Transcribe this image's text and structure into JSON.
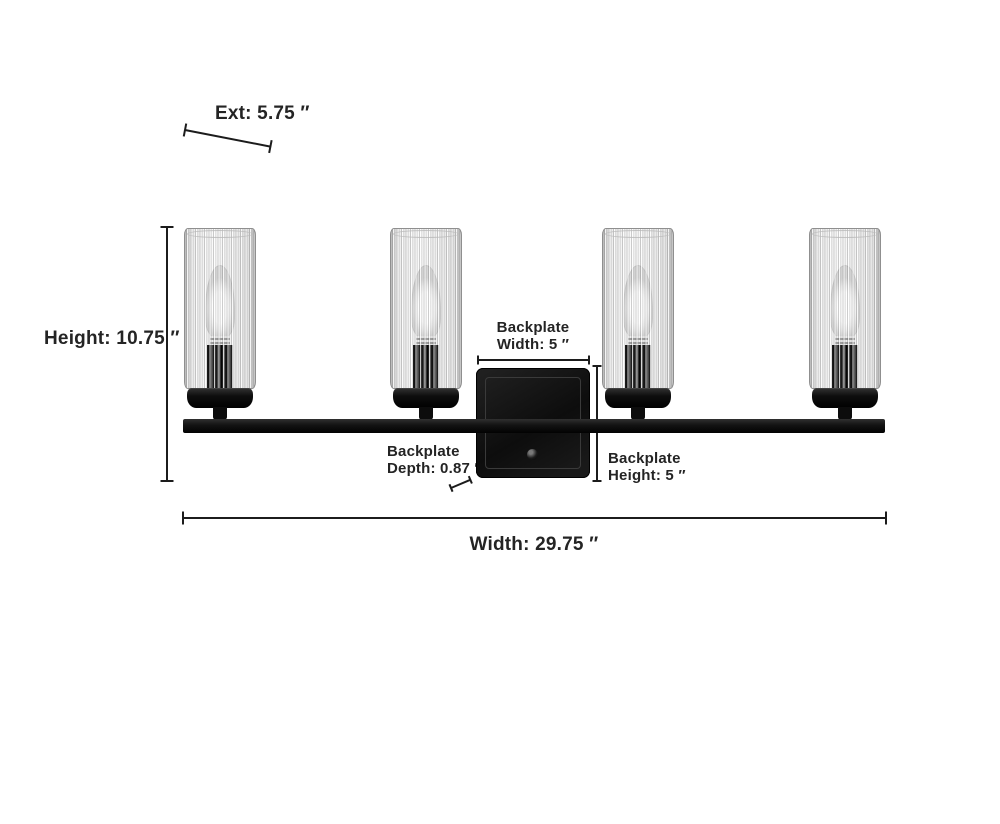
{
  "background": "#ffffff",
  "fixture": {
    "description": "4-light black bath vanity fixture with fluted clear glass cylinder shades and square backplate",
    "num_lights": 4,
    "finish_color": "#121212",
    "glass_color": "#f4f4f4"
  },
  "annotations": {
    "ext": "Ext: 5.75 ″",
    "height": "Height: 10.75 ″",
    "width": "Width: 29.75 ″",
    "backplate_width": {
      "line1": "Backplate",
      "line2": "Width: 5 ″"
    },
    "backplate_height": {
      "line1": "Backplate",
      "line2": "Height: 5 ″"
    },
    "backplate_depth": {
      "line1": "Backplate",
      "line2": "Depth: 0.87 ″"
    }
  },
  "colors": {
    "dimension_lines": "#1c1c1c",
    "label_text": "#242424"
  }
}
